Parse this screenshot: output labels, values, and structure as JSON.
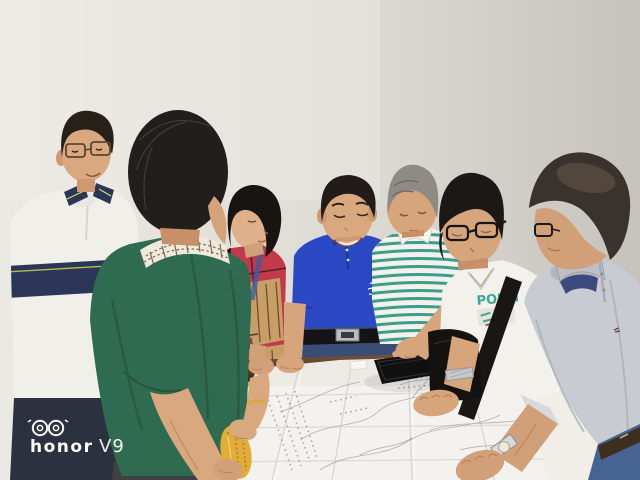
{
  "watermark": {
    "brand": "honor",
    "model": "V9",
    "icon": "dual-camera-icon",
    "text_color": "#FFFFFF"
  },
  "scene": {
    "description": "Seven people stand around a table in a bright room, leaning over a large unfolded technical map; one man touches a black tablet lying on the map.",
    "setting": "plain light gray wall, dark wood table edge, large white folded map covering the table",
    "people": [
      {
        "id": "man-left",
        "clothing": "white polo with navy chest stripe and navy striped collar, dark navy trousers",
        "hair": "black",
        "accessories": "glasses"
      },
      {
        "id": "man-green",
        "clothing": "dark green polo over a checked-collar shirt, dark gray trousers",
        "hair": "black, seen from behind",
        "accessories": ""
      },
      {
        "id": "woman",
        "clothing": "multicolor patchwork blouse",
        "hair": "black bob",
        "accessories": "gold bracelet",
        "holding": "yellow textured object"
      },
      {
        "id": "man-blue",
        "clothing": "royal blue polo with white crest logo, jeans with black belt and silver buckle",
        "hair": "black",
        "accessories": "",
        "expression": "smiling"
      },
      {
        "id": "man-striped",
        "clothing": "teal and white striped polo",
        "hair": "gray",
        "action": "pointing at tablet",
        "print": ""
      },
      {
        "id": "man-white-tee",
        "clothing": "white v-neck tee with teal print, black shoulder-bag strap",
        "hair": "black",
        "accessories": "black glasses, silver watch",
        "print": "POEM"
      },
      {
        "id": "man-gray-polo",
        "clothing": "light gray polo, blue jeans with brown belt",
        "hair": "short, thinning",
        "accessories": "glasses, silver wristwatch"
      }
    ],
    "objects": [
      {
        "id": "map",
        "description": "large white unfolded map with crease grid and faint plotted lines"
      },
      {
        "id": "tablet",
        "description": "black tablet lying on the map"
      },
      {
        "id": "wood-table-edge",
        "description": "dark brown wooden table edge"
      },
      {
        "id": "yellow-object",
        "description": "yellow textured object held by the woman"
      }
    ],
    "colors": {
      "wall_left": "#EBE9E3",
      "wall_right": "#C5C3BC",
      "map_paper": "#F3F2EE",
      "wood": "#5E4028",
      "green_polo": "#2F6B50",
      "blue_polo": "#2B48C5",
      "stripe_teal": "#3D9C8B",
      "blouse_red": "#C23A4A",
      "skin": "#D7A57C",
      "yellow_object": "#E2AC38",
      "watermark": "#FFFFFF"
    }
  }
}
